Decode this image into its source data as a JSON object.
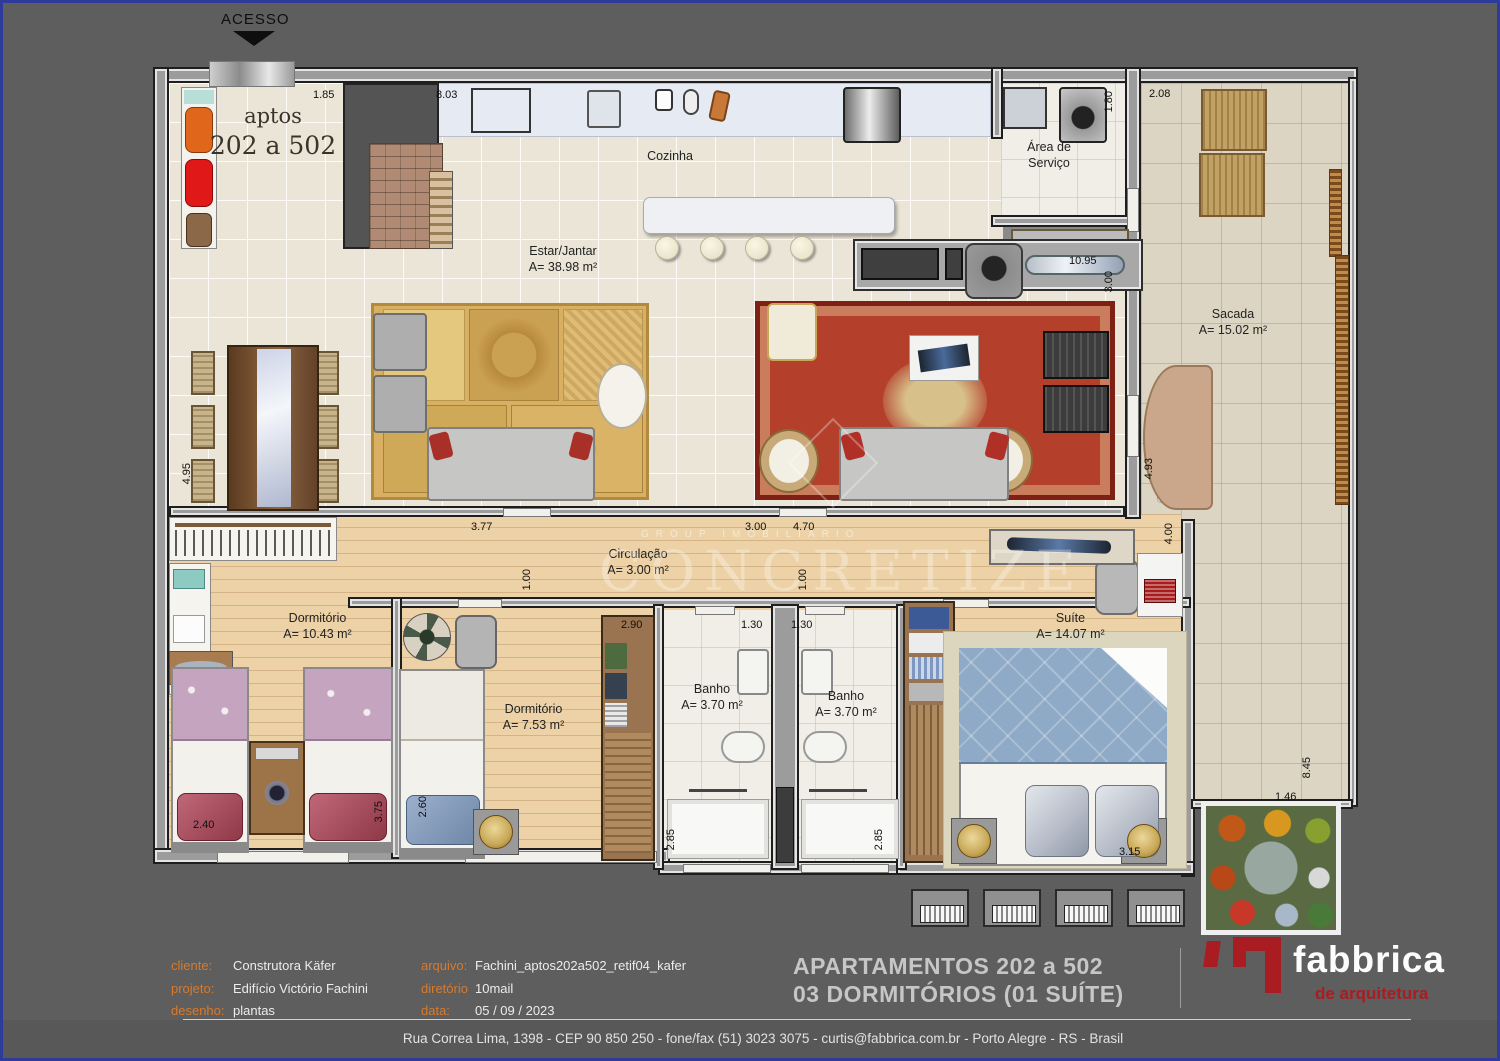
{
  "access": {
    "label": "ACESSO"
  },
  "unit": {
    "line1": "aptos",
    "line2": "202 a 502"
  },
  "rooms": {
    "cozinha": {
      "name": "Cozinha"
    },
    "servico": {
      "name1": "Área de",
      "name2": "Serviço"
    },
    "estar": {
      "name": "Estar/Jantar",
      "area": "A= 38.98 m²"
    },
    "sacada": {
      "name": "Sacada",
      "area": "A= 15.02 m²"
    },
    "circulacao": {
      "name": "Circulação",
      "area": "A= 3.00 m²"
    },
    "dorm1": {
      "name": "Dormitório",
      "area": "A= 10.43 m²"
    },
    "dorm2": {
      "name": "Dormitório",
      "area": "A= 7.53 m²"
    },
    "banho1": {
      "name": "Banho",
      "area": "A= 3.70 m²"
    },
    "banho2": {
      "name": "Banho",
      "area": "A= 3.70 m²"
    },
    "suite": {
      "name": "Suíte",
      "area": "A= 14.07 m²"
    }
  },
  "dims": {
    "entry_width": "1.85",
    "kitchen_width": "8.03",
    "service_depth": "1.80",
    "sacada_top_width": "2.08",
    "living_width": "10.95",
    "living_depth": "3.00",
    "dining_height": "4.95",
    "circ_left": "3.77",
    "circ_mid": "3.00",
    "circ_right": "4.70",
    "door1": "1.00",
    "door2": "1.00",
    "closet2": "2.90",
    "banho1_width": "1.30",
    "banho2_width": "1.30",
    "suite_width": "4.00",
    "sacada_left_height": "4.93",
    "dorm1_width": "2.40",
    "dorm1_height": "3.75",
    "dorm2_height": "2.60",
    "banho1_height": "2.85",
    "banho2_height": "2.85",
    "suite_height": "3.15",
    "sacada_right_height": "8.45",
    "garden_width": "1.46"
  },
  "watermark": {
    "group": "GROUP IMOBILIARIO",
    "brand": "CONCRETIZE"
  },
  "title_block": {
    "cliente_label": "cliente:",
    "cliente": "Construtora Käfer",
    "projeto_label": "projeto:",
    "projeto": "Edifício Victório Fachini",
    "desenho_label": "desenho:",
    "desenho": "plantas",
    "arquivo_label": "arquivo:",
    "arquivo": "Fachini_aptos202a502_retif04_kafer",
    "diretorio_label": "diretório",
    "diretorio": "10mail",
    "data_label": "data:",
    "data": "05 / 09 / 2023",
    "title_line1": "APARTAMENTOS 202 a 502",
    "title_line2": "03 DORMITÓRIOS (01 SUÍTE)"
  },
  "logo": {
    "name": "fabbrica",
    "subtitle": "de arquitetura"
  },
  "footer": {
    "address": "Rua Correa Lima, 1398   -   CEP 90 850 250   -   fone/fax (51) 3023 3075   -   curtis@fabbrica.com.br   -   Porto Alegre   -   RS   -   Brasil"
  }
}
